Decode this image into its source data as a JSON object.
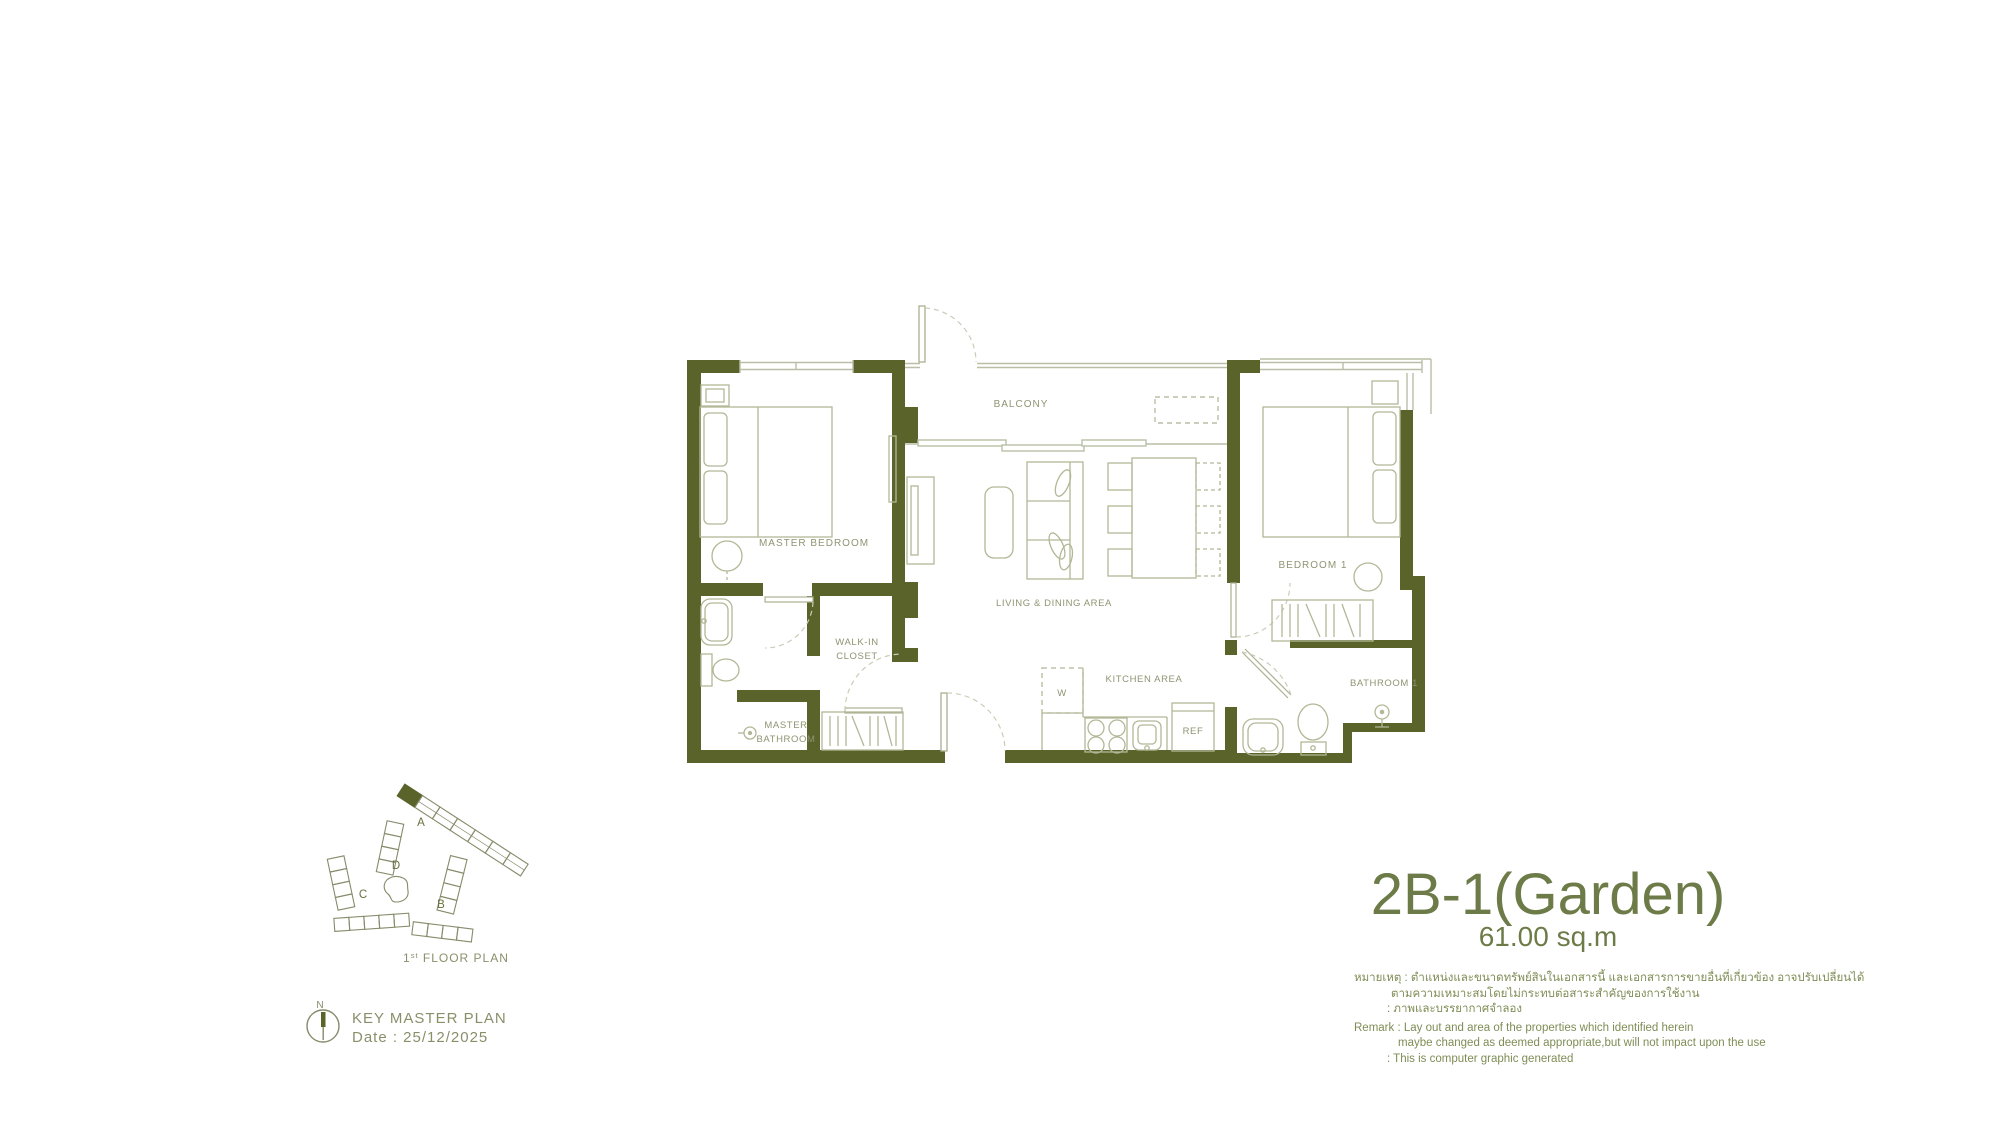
{
  "plan": {
    "labels": {
      "balcony": "BALCONY",
      "master_bedroom": "MASTER BEDROOM",
      "bedroom_1": "BEDROOM 1",
      "living_dining": "LIVING & DINING AREA",
      "walk_in_1": "WALK-IN",
      "walk_in_2": "CLOSET",
      "master_bath_1": "MASTER",
      "master_bath_2": "BATHROOM",
      "kitchen": "KITCHEN AREA",
      "bathroom_1": "BATHROOM 1",
      "washer": "W",
      "refrigerator": "REF"
    }
  },
  "key_plan": {
    "building_a": "A",
    "building_b": "B",
    "building_c": "C",
    "building_d": "D",
    "floor_num": "1",
    "floor_sup": "st",
    "floor_rest": " FLOOR PLAN",
    "compass": "N",
    "title": "KEY MASTER  PLAN",
    "date": "Date  : 25/12/2025"
  },
  "title_block": {
    "name": "2B-1(Garden)",
    "area": "61.00 sq.m"
  },
  "remark": {
    "lines": [
      "หมายเหตุ : ตำแหน่งและขนาดทรัพย์สินในเอกสารนี้ และเอกสารการขายอื่นที่เกี่ยวข้อง อาจปรับเปลี่ยนได้",
      "ตามความเหมาะสมโดยไม่กระทบต่อสาระสำคัญของการใช้งาน",
      ": ภาพและบรรยากาศจำลอง",
      "Remark   : Lay out and area of the properties which identified herein",
      "maybe changed as deemed appropriate,but will not impact upon the use",
      ": This is computer graphic generated"
    ]
  },
  "colors": {
    "wall": "#59632a",
    "thin_line": "#b9bfa6",
    "furniture_line": "#b2b896",
    "door_arc": "#c9cdb8",
    "room_label": "#8f9472",
    "title_text": "#6c7b47",
    "remark_text": "#7e8d55",
    "key_plan_line": "#868b6a"
  }
}
